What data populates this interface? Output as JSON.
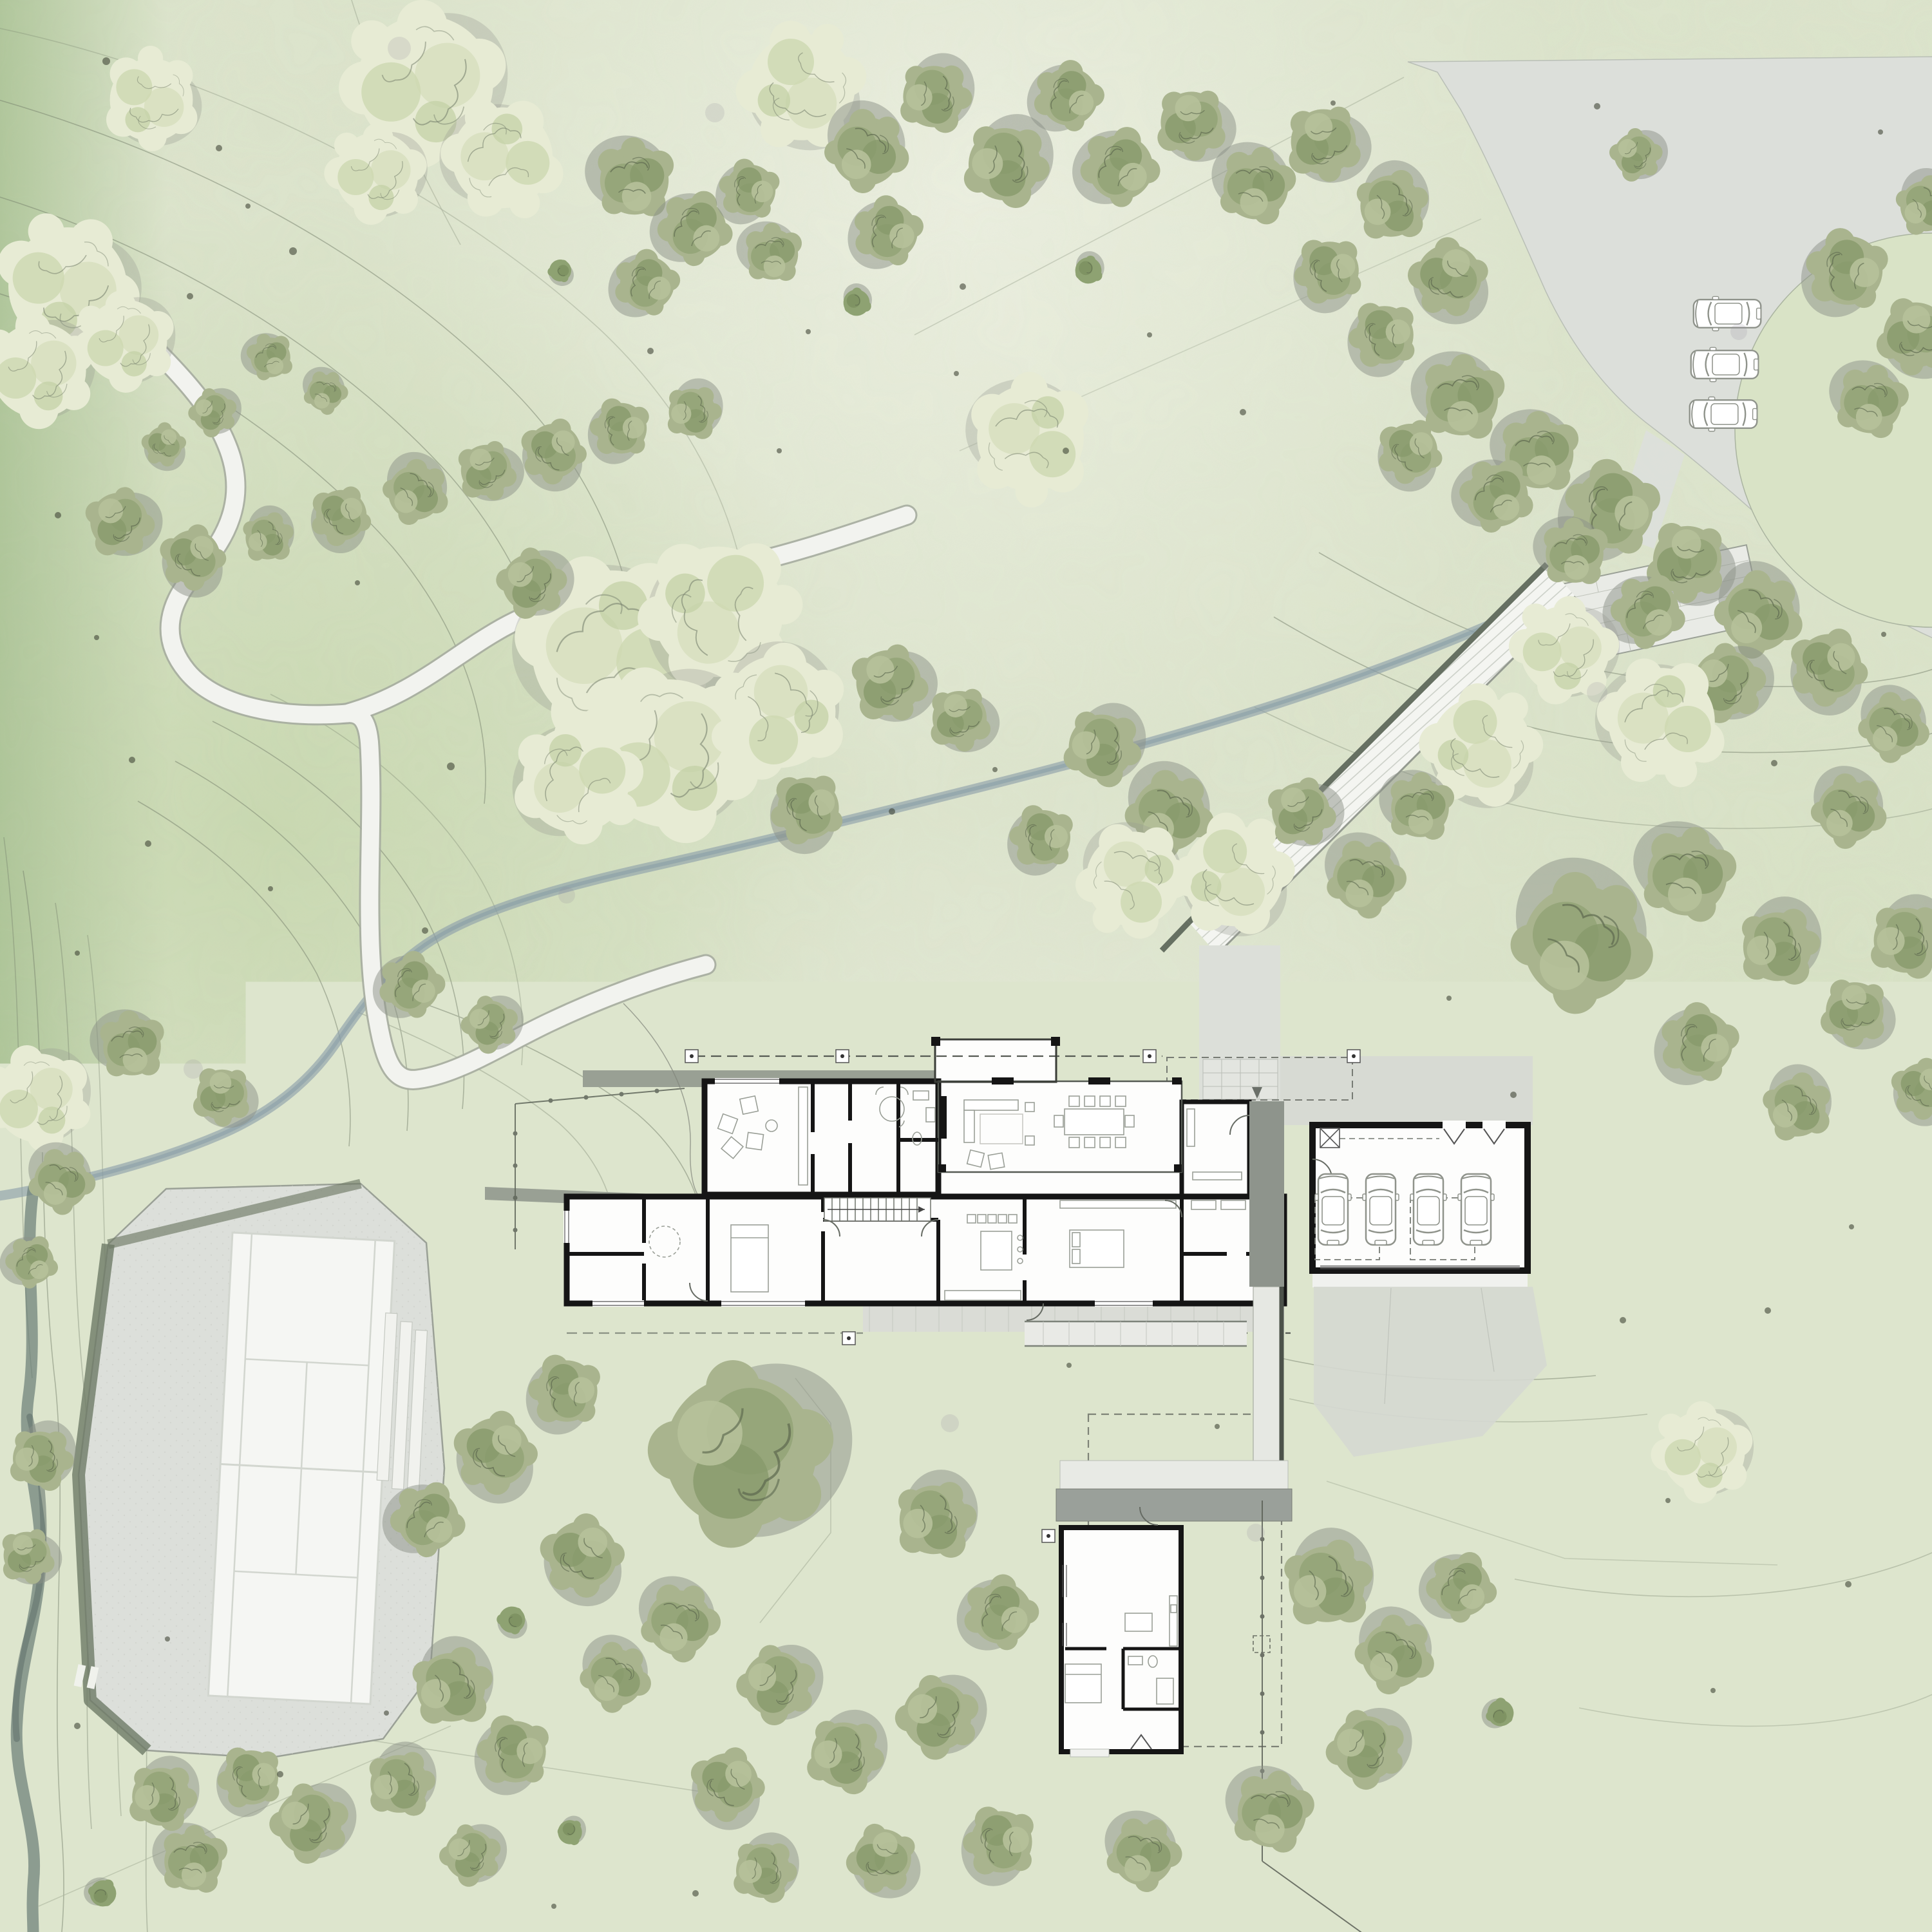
{
  "drawing": {
    "type": "architectural-site-plan",
    "style": "watercolor landscape plan"
  },
  "legend": {
    "scale_labels": [
      "4'",
      "8'",
      "16'",
      "32'"
    ],
    "north_marker": "north-arrow-circle"
  },
  "palette": {
    "paper": "#dde5cd",
    "grass_dark": "#b9cf9e",
    "contour": "#76816c",
    "stream": "#8fa2ab",
    "stream_dark": "#6a7d76",
    "path_fill": "#f2f3ef",
    "path_edge": "#a6aca0",
    "driveway": "#dcdfda",
    "court_pad": "#e2e4df",
    "court_white": "#f5f6f3",
    "wall_black": "#151515",
    "roof_band": "#99a094",
    "walk_roof": "#8e948c",
    "deck": "#dadcd6",
    "tree_olive": "#a9b48e",
    "tree_pale": "#e7ebd4",
    "shadow": "#8b9288",
    "dot": "#414637",
    "legend_ink": "#1f1f1f"
  },
  "counts": {
    "garage_cars": 4,
    "parking_cars": 3
  },
  "scene": {
    "trees": [
      [
        235,
        155,
        0.7,
        "p"
      ],
      [
        660,
        130,
        1.15,
        "p"
      ],
      [
        780,
        245,
        0.85,
        "p"
      ],
      [
        585,
        270,
        0.7,
        "p"
      ],
      [
        105,
        445,
        1.0,
        "p"
      ],
      [
        60,
        575,
        0.8,
        "p"
      ],
      [
        195,
        530,
        0.7,
        "p"
      ],
      [
        330,
        640,
        0.55,
        "o"
      ],
      [
        255,
        690,
        0.5,
        "o"
      ],
      [
        420,
        555,
        0.55,
        "o"
      ],
      [
        505,
        610,
        0.5,
        "o"
      ],
      [
        985,
        280,
        0.95,
        "o"
      ],
      [
        1080,
        355,
        0.85,
        "o"
      ],
      [
        1005,
        440,
        0.75,
        "o"
      ],
      [
        1165,
        295,
        0.7,
        "o"
      ],
      [
        1245,
        135,
        0.9,
        "p"
      ],
      [
        1345,
        235,
        0.95,
        "o"
      ],
      [
        1450,
        150,
        0.85,
        "o"
      ],
      [
        1560,
        255,
        1.0,
        "o"
      ],
      [
        1660,
        150,
        0.8,
        "o"
      ],
      [
        1740,
        260,
        0.9,
        "o"
      ],
      [
        1850,
        190,
        0.85,
        "o"
      ],
      [
        1950,
        290,
        0.9,
        "o"
      ],
      [
        1380,
        360,
        0.8,
        "o"
      ],
      [
        1200,
        395,
        0.7,
        "o"
      ],
      [
        1330,
        470,
        0.6,
        "s"
      ],
      [
        1690,
        420,
        0.6,
        "s"
      ],
      [
        870,
        420,
        0.5,
        "s"
      ],
      [
        1600,
        680,
        0.9,
        "p"
      ],
      [
        2055,
        220,
        0.9,
        "o"
      ],
      [
        2160,
        320,
        0.85,
        "o"
      ],
      [
        2065,
        420,
        0.8,
        "o"
      ],
      [
        2250,
        430,
        0.9,
        "o"
      ],
      [
        2150,
        520,
        0.8,
        "o"
      ],
      [
        2540,
        240,
        0.6,
        "o"
      ],
      [
        2870,
        420,
        0.95,
        "o"
      ],
      [
        2975,
        520,
        0.9,
        "o"
      ],
      [
        2905,
        625,
        0.85,
        "o"
      ],
      [
        2990,
        320,
        0.7,
        "o"
      ],
      [
        185,
        810,
        0.8,
        "o"
      ],
      [
        300,
        865,
        0.75,
        "o"
      ],
      [
        415,
        835,
        0.6,
        "o"
      ],
      [
        530,
        800,
        0.7,
        "o"
      ],
      [
        645,
        765,
        0.75,
        "o"
      ],
      [
        755,
        730,
        0.7,
        "o"
      ],
      [
        860,
        700,
        0.75,
        "o"
      ],
      [
        965,
        665,
        0.7,
        "o"
      ],
      [
        1075,
        640,
        0.65,
        "o"
      ],
      [
        950,
        1010,
        1.35,
        "p"
      ],
      [
        1115,
        950,
        1.1,
        "p"
      ],
      [
        1040,
        1170,
        1.25,
        "p"
      ],
      [
        1210,
        1105,
        0.95,
        "p"
      ],
      [
        895,
        1210,
        0.9,
        "p"
      ],
      [
        825,
        905,
        0.8,
        "o"
      ],
      [
        1255,
        1255,
        0.85,
        "o"
      ],
      [
        1380,
        1060,
        0.9,
        "o"
      ],
      [
        1490,
        1115,
        0.75,
        "o"
      ],
      [
        2270,
        620,
        1.0,
        "o"
      ],
      [
        2390,
        705,
        0.95,
        "o"
      ],
      [
        2505,
        790,
        1.1,
        "o"
      ],
      [
        2620,
        870,
        0.95,
        "o"
      ],
      [
        2730,
        955,
        1.0,
        "o"
      ],
      [
        2840,
        1035,
        0.9,
        "o"
      ],
      [
        2325,
        770,
        0.85,
        "o"
      ],
      [
        2445,
        860,
        0.8,
        "o"
      ],
      [
        2560,
        950,
        0.85,
        "o"
      ],
      [
        2680,
        1060,
        0.9,
        "o"
      ],
      [
        2940,
        1130,
        0.8,
        "o"
      ],
      [
        2190,
        700,
        0.75,
        "o"
      ],
      [
        2580,
        1120,
        0.9,
        "p"
      ],
      [
        2430,
        1010,
        0.75,
        "p"
      ],
      [
        2300,
        1160,
        0.85,
        "p"
      ],
      [
        2205,
        1255,
        0.8,
        "o"
      ],
      [
        1710,
        1160,
        0.9,
        "o"
      ],
      [
        1815,
        1265,
        1.0,
        "o"
      ],
      [
        1915,
        1360,
        0.85,
        "p"
      ],
      [
        1760,
        1365,
        0.8,
        "p"
      ],
      [
        1620,
        1300,
        0.75,
        "o"
      ],
      [
        2020,
        1260,
        0.8,
        "o"
      ],
      [
        2120,
        1365,
        0.9,
        "o"
      ],
      [
        2455,
        1465,
        1.6,
        "o"
      ],
      [
        2620,
        1360,
        1.1,
        "o"
      ],
      [
        2760,
        1470,
        0.95,
        "o"
      ],
      [
        2870,
        1260,
        0.85,
        "o"
      ],
      [
        2640,
        1620,
        0.9,
        "o"
      ],
      [
        2790,
        1720,
        0.8,
        "o"
      ],
      [
        2960,
        1460,
        0.9,
        "o"
      ],
      [
        2880,
        1570,
        0.8,
        "o"
      ],
      [
        2985,
        1690,
        0.7,
        "o"
      ],
      [
        2860,
        2120,
        0.6,
        "s"
      ],
      [
        2645,
        2255,
        0.7,
        "p"
      ],
      [
        640,
        1530,
        0.75,
        "o"
      ],
      [
        760,
        1590,
        0.65,
        "o"
      ],
      [
        60,
        1705,
        0.75,
        "p"
      ],
      [
        205,
        1625,
        0.8,
        "o"
      ],
      [
        345,
        1700,
        0.7,
        "o"
      ],
      [
        95,
        1835,
        0.75,
        "o"
      ],
      [
        50,
        1960,
        0.6,
        "o"
      ],
      [
        62,
        2265,
        0.75,
        "o"
      ],
      [
        42,
        2415,
        0.65,
        "o"
      ],
      [
        1150,
        2255,
        2.1,
        "o"
      ],
      [
        880,
        2160,
        0.85,
        "o"
      ],
      [
        770,
        2255,
        0.95,
        "o"
      ],
      [
        665,
        2360,
        0.85,
        "o"
      ],
      [
        905,
        2415,
        0.95,
        "o"
      ],
      [
        1055,
        2520,
        0.9,
        "o"
      ],
      [
        795,
        2515,
        0.6,
        "s"
      ],
      [
        955,
        2605,
        0.8,
        "o"
      ],
      [
        1205,
        2615,
        0.9,
        "o"
      ],
      [
        1450,
        2360,
        0.95,
        "o"
      ],
      [
        1555,
        2505,
        0.85,
        "o"
      ],
      [
        1455,
        2665,
        0.95,
        "o"
      ],
      [
        1310,
        2725,
        0.9,
        "o"
      ],
      [
        1130,
        2770,
        0.85,
        "o"
      ],
      [
        1555,
        2860,
        0.85,
        "o"
      ],
      [
        1370,
        2885,
        0.8,
        "o"
      ],
      [
        1185,
        2905,
        0.75,
        "o"
      ],
      [
        2060,
        2460,
        1.05,
        "o"
      ],
      [
        2165,
        2570,
        0.9,
        "o"
      ],
      [
        2270,
        2465,
        0.8,
        "o"
      ],
      [
        2120,
        2715,
        0.9,
        "o"
      ],
      [
        1975,
        2815,
        0.95,
        "o"
      ],
      [
        1775,
        2880,
        0.85,
        "o"
      ],
      [
        2330,
        2660,
        0.6,
        "s"
      ],
      [
        2470,
        2560,
        0.65,
        "o"
      ],
      [
        700,
        2620,
        0.95,
        "o"
      ],
      [
        800,
        2720,
        0.85,
        "o"
      ],
      [
        620,
        2770,
        0.8,
        "o"
      ],
      [
        480,
        2830,
        0.9,
        "o"
      ],
      [
        300,
        2890,
        0.8,
        "o"
      ],
      [
        160,
        2940,
        0.6,
        "s"
      ],
      [
        730,
        2880,
        0.7,
        "o"
      ],
      [
        885,
        2845,
        0.55,
        "s"
      ],
      [
        390,
        2760,
        0.75,
        "o"
      ],
      [
        250,
        2790,
        0.8,
        "o"
      ]
    ],
    "dots": [
      [
        165,
        95,
        6
      ],
      [
        340,
        230,
        5
      ],
      [
        455,
        390,
        6
      ],
      [
        90,
        800,
        5
      ],
      [
        555,
        905,
        4
      ],
      [
        700,
        1190,
        6
      ],
      [
        230,
        1310,
        5
      ],
      [
        120,
        1480,
        4
      ],
      [
        1010,
        545,
        5
      ],
      [
        1255,
        515,
        4
      ],
      [
        1495,
        445,
        5
      ],
      [
        1785,
        520,
        4
      ],
      [
        1930,
        640,
        5
      ],
      [
        1210,
        700,
        4
      ],
      [
        1655,
        700,
        5
      ],
      [
        2070,
        160,
        4
      ],
      [
        2480,
        165,
        5
      ],
      [
        2920,
        205,
        4
      ],
      [
        2755,
        1185,
        5
      ],
      [
        2925,
        985,
        4
      ],
      [
        1385,
        1260,
        5
      ],
      [
        1545,
        1195,
        4
      ],
      [
        205,
        1180,
        5
      ],
      [
        420,
        1380,
        4
      ],
      [
        660,
        1445,
        5
      ],
      [
        2250,
        1550,
        4
      ],
      [
        2350,
        1700,
        5
      ],
      [
        2875,
        1905,
        4
      ],
      [
        2745,
        2035,
        5
      ],
      [
        2590,
        2330,
        4
      ],
      [
        2870,
        2460,
        5
      ],
      [
        2660,
        2625,
        4
      ],
      [
        2420,
        2830,
        5
      ],
      [
        2240,
        2935,
        4
      ],
      [
        1080,
        2940,
        5
      ],
      [
        860,
        2960,
        4
      ],
      [
        600,
        2660,
        4
      ],
      [
        435,
        2755,
        5
      ],
      [
        260,
        2545,
        4
      ],
      [
        120,
        2680,
        5
      ],
      [
        1890,
        2215,
        4
      ],
      [
        1660,
        2120,
        4
      ],
      [
        2520,
        2050,
        5
      ],
      [
        2970,
        2740,
        4
      ],
      [
        2820,
        2890,
        5
      ],
      [
        295,
        460,
        5
      ],
      [
        385,
        320,
        4
      ],
      [
        150,
        990,
        4
      ],
      [
        2985,
        2210,
        4
      ],
      [
        1485,
        580,
        4
      ]
    ],
    "blotches": [
      [
        620,
        75,
        18
      ],
      [
        1110,
        175,
        15
      ],
      [
        2480,
        1075,
        16
      ],
      [
        1475,
        2210,
        14
      ],
      [
        300,
        1660,
        15
      ],
      [
        2700,
        515,
        13
      ],
      [
        1950,
        2380,
        14
      ],
      [
        880,
        1390,
        13
      ]
    ],
    "garage_cars": [
      [
        2070,
        1878
      ],
      [
        2144,
        1878
      ],
      [
        2218,
        1878
      ],
      [
        2292,
        1878
      ]
    ],
    "parking_cars": [
      [
        2682,
        487
      ],
      [
        2678,
        566
      ],
      [
        2676,
        643
      ]
    ]
  }
}
